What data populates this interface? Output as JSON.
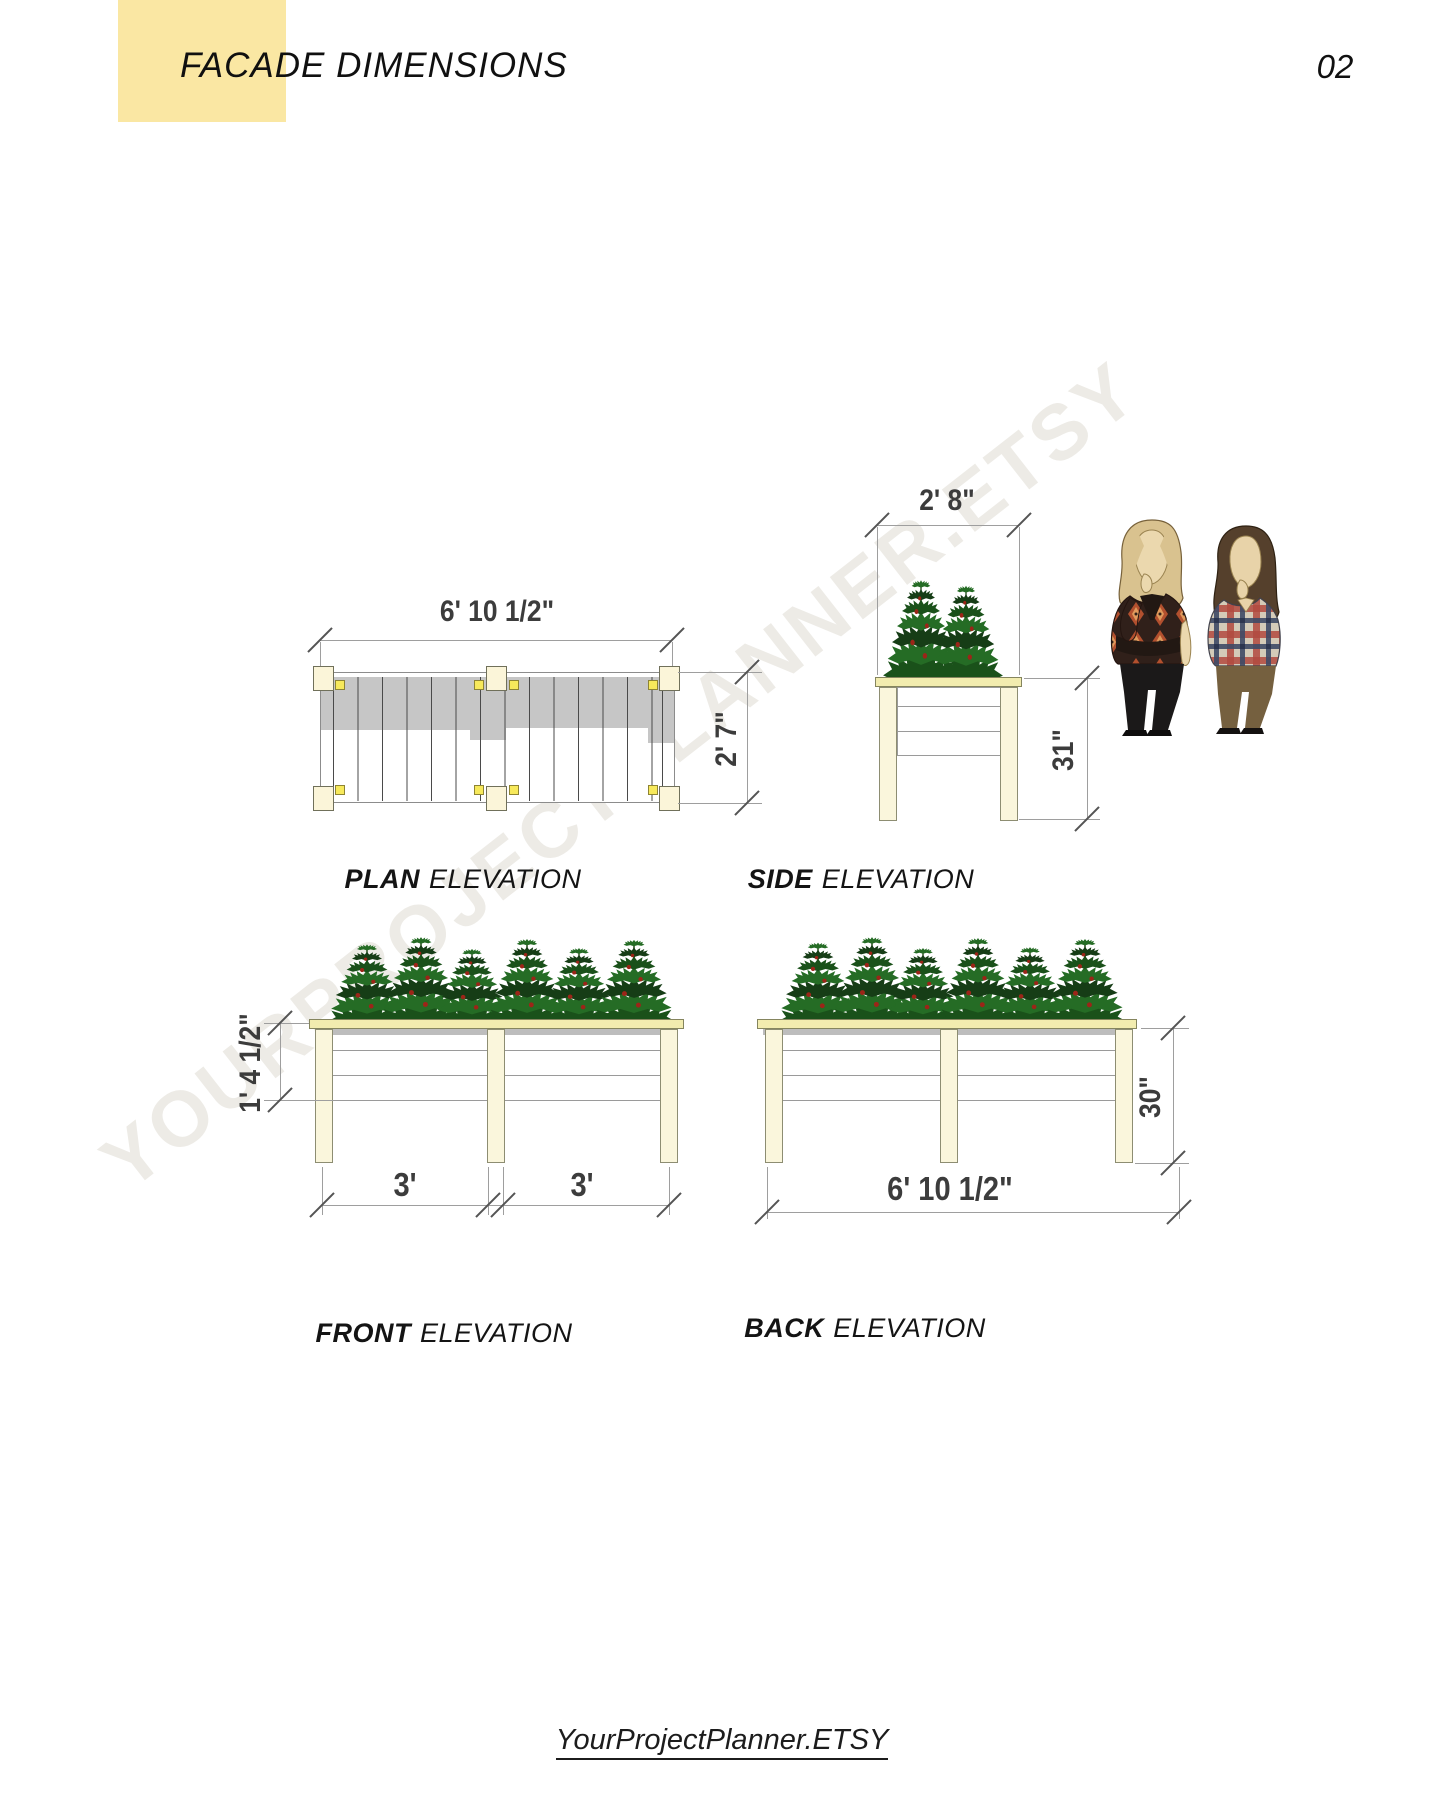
{
  "header": {
    "title": "FACADE DIMENSIONS",
    "page_number": "02"
  },
  "watermark": {
    "text": "YOURPROJECTPLANNER.ETSY"
  },
  "footer": {
    "link_text": "YourProjectPlanner.ETSY"
  },
  "views": {
    "plan": {
      "name_bold": "PLAN",
      "name_rest": "ELEVATION",
      "dim_width": "6' 10 1/2\"",
      "dim_depth": "2' 7\""
    },
    "side": {
      "name_bold": "SIDE",
      "name_rest": "ELEVATION",
      "dim_width": "2' 8\"",
      "dim_height": "31\""
    },
    "front": {
      "name_bold": "FRONT",
      "name_rest": "ELEVATION",
      "dim_box_height": "1' 4 1/2\"",
      "dim_bay_left": "3'",
      "dim_bay_right": "3'"
    },
    "back": {
      "name_bold": "BACK",
      "name_rest": "ELEVATION",
      "dim_height": "30\"",
      "dim_width": "6' 10 1/2\""
    }
  },
  "colors": {
    "accent_yellow": "#FAE7A3",
    "wood_cream": "#FAF6DC",
    "wood_cap": "#F2ECAF",
    "hardware_yellow": "#F7E95B",
    "shading_gray": "#C6C6C6",
    "foliage_green": "#1A511A",
    "tomato_red": "#9C2518"
  }
}
